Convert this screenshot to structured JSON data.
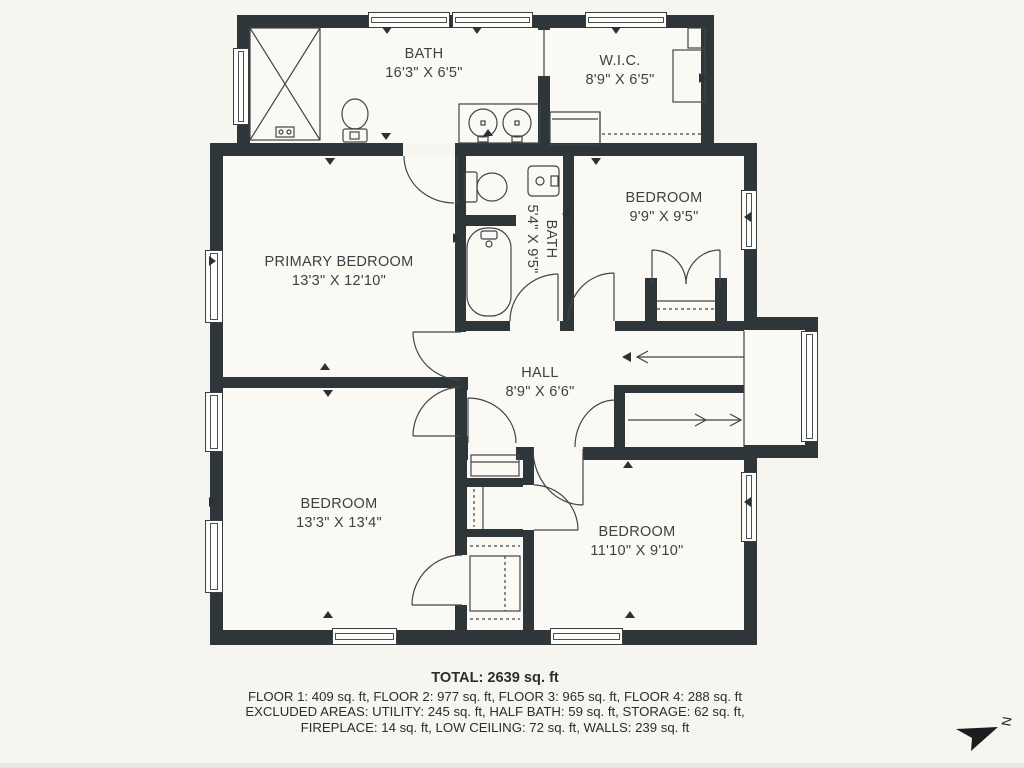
{
  "rooms": [
    {
      "id": "bath-top",
      "name": "BATH",
      "dims": "16'3\" X 6'5\""
    },
    {
      "id": "wic",
      "name": "W.I.C.",
      "dims": "8'9\" X 6'5\""
    },
    {
      "id": "primary-bedroom",
      "name": "PRIMARY BEDROOM",
      "dims": "13'3\" X 12'10\""
    },
    {
      "id": "bath-small",
      "name": "BATH",
      "dims": "5'4\" X 9'5\""
    },
    {
      "id": "bedroom-ne",
      "name": "BEDROOM",
      "dims": "9'9\" X 9'5\""
    },
    {
      "id": "hall",
      "name": "HALL",
      "dims": "8'9\" X 6'6\""
    },
    {
      "id": "bedroom-sw",
      "name": "BEDROOM",
      "dims": "13'3\" X 13'4\""
    },
    {
      "id": "bedroom-se",
      "name": "BEDROOM",
      "dims": "11'10\" X 9'10\""
    }
  ],
  "footer": {
    "total": "TOTAL: 2639 sq. ft",
    "floors": "FLOOR 1: 409 sq. ft, FLOOR 2: 977 sq. ft, FLOOR 3: 965 sq. ft, FLOOR 4: 288 sq. ft",
    "excluded1": "EXCLUDED AREAS: UTILITY: 245 sq. ft, HALF BATH: 59 sq. ft, STORAGE: 62 sq. ft,",
    "excluded2": "FIREPLACE: 14 sq. ft, LOW CEILING: 72 sq. ft, WALLS: 239 sq. ft"
  },
  "compass": {
    "label": "N"
  },
  "colors": {
    "wall": "#2f363a",
    "background": "#f6f5ef",
    "line": "#3f4548",
    "text": "#3c4145"
  }
}
